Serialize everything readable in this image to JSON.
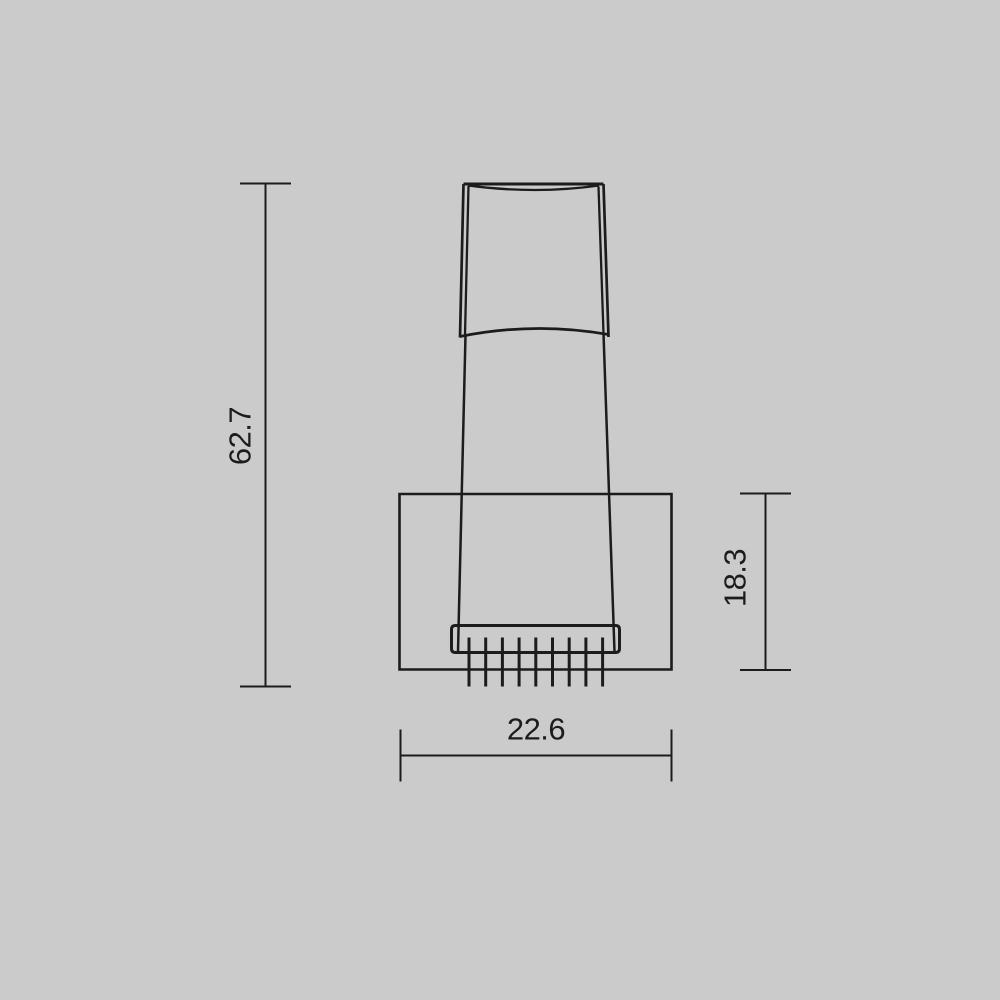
{
  "colors": {
    "background": "#cbcbcb",
    "line": "#1c1c1c",
    "text": "#1c1c1c"
  },
  "drawing": {
    "type": "technical-dimension-drawing",
    "subject": "wall-lamp-side-profile",
    "viewbox": "0 0 1000 1000",
    "outline_paths": [
      {
        "name": "shade-top-edge",
        "d": "M463.5 184 L603.5 184",
        "w": 3
      },
      {
        "name": "shade-top-curve",
        "d": "M468 185.5 Q535.5 194.5 599 185.5",
        "w": 2.3
      },
      {
        "name": "shade-left-outer",
        "d": "M463.5 184 L460 337.5",
        "w": 2.7
      },
      {
        "name": "shade-left-inner",
        "d": "M468.5 186 L465 335",
        "w": 2.3
      },
      {
        "name": "shade-right-outer",
        "d": "M603.5 184 L608.5 337",
        "w": 2.7
      },
      {
        "name": "shade-right-inner",
        "d": "M598.5 186.5 L603.5 333.5",
        "w": 2.3
      },
      {
        "name": "shade-bottom-curve",
        "d": "M460 336.5 Q534 321.5 608.5 334.5",
        "w": 2.7
      },
      {
        "name": "stem-left-edge",
        "d": "M465.5 335 L458 651.5",
        "w": 2.5
      },
      {
        "name": "stem-right-edge",
        "d": "M603.5 333.5 L614.5 651.5",
        "w": 2.5
      },
      {
        "name": "backplate-outline",
        "d": "M399.5 494 L671.5 494 L671.5 669.5 L399.5 669.5 Z",
        "w": 2.6
      },
      {
        "name": "head-bar-outline",
        "d": "M455.5 625.5 L615.5 625.5 Q619.5 625.5 619.5 629.5 L619.5 648.5 Q619.5 652.5 615.5 652.5 L455.5 652.5 Q451.5 652.5 451.5 648.5 L451.5 629.5 Q451.5 625.5 455.5 625.5 Z",
        "w": 3
      }
    ],
    "teeth": {
      "name": "heatsink-fin",
      "count": 9,
      "x_start": 469,
      "x_step": 16.7,
      "y_top": 637.5,
      "y_bottom": 686.5,
      "w": 3
    },
    "dimensions": [
      {
        "name": "overall-height",
        "value": "62.7",
        "orientation": "vertical",
        "line_x": 265.5,
        "from_y": 183.5,
        "to_y": 686.5,
        "cap_half_len": 25.5,
        "label_x": 240,
        "label_y": 436,
        "line_w": 2
      },
      {
        "name": "backplate-height",
        "value": "18.3",
        "orientation": "vertical",
        "line_x": 765.5,
        "from_y": 493.5,
        "to_y": 670,
        "cap_half_len": 25.5,
        "label_x": 735,
        "label_y": 578,
        "line_w": 2
      },
      {
        "name": "backplate-width",
        "value": "22.6",
        "orientation": "horizontal",
        "line_y": 755.5,
        "from_x": 400.5,
        "to_x": 671.5,
        "cap_half_len": 26,
        "label_x": 536,
        "label_y": 729,
        "line_w": 2
      }
    ]
  }
}
